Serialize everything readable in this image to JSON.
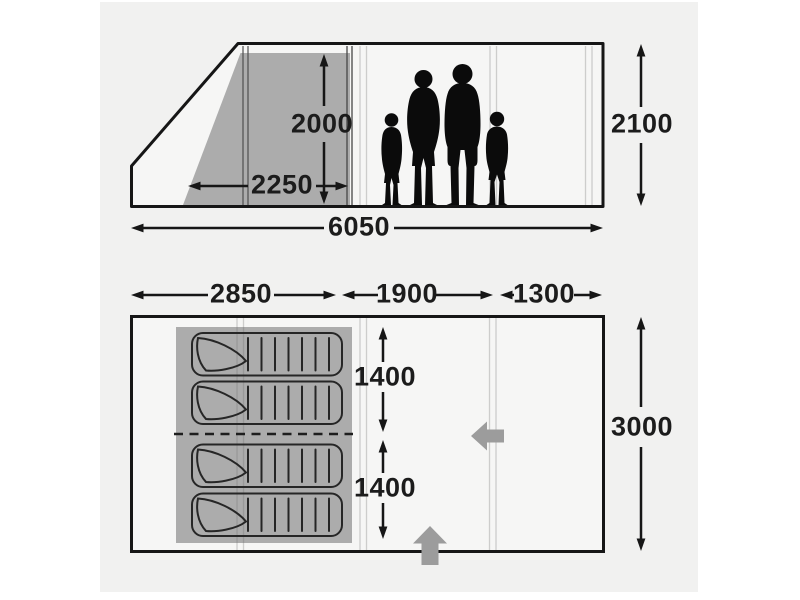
{
  "colors": {
    "canvas_bg": "#f1f1f0",
    "inner_gray": "#acacac",
    "door_arrow": "#9c9c9c",
    "ink": "#161616",
    "text": "#1c1c1c"
  },
  "side_view": {
    "dimensions": {
      "inner_height": "2000",
      "inner_width": "2250",
      "total_length": "6050",
      "total_height": "2100"
    }
  },
  "floor_plan": {
    "dimensions": {
      "sleeping_length": "2850",
      "living_length": "1900",
      "canopy_length": "1300",
      "sleeping_width_upper": "1400",
      "sleeping_width_lower": "1400",
      "total_width": "3000"
    }
  }
}
